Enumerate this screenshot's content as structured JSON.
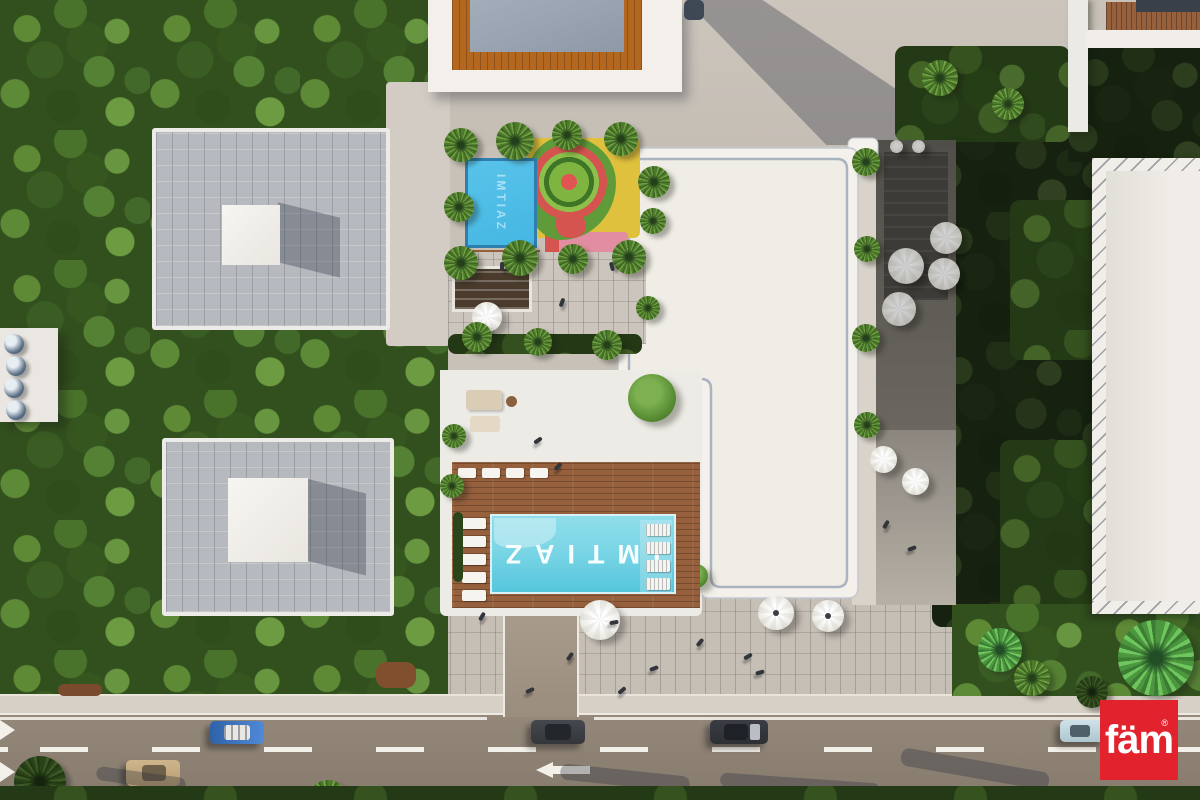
{
  "scene": {
    "description": "Aerial top-down 3D architectural render of the IMTIAZ residential development: central white L-shaped building with rooftop amenity deck, branded swimming pool, kids splash playground, landscaped villas among trees on the left, shaded cafe terrace with umbrellas on the right, and a three-lane road with cars along the bottom."
  },
  "branding": {
    "pool_text": "IMTIAZ",
    "pool_text_orientation": "rotated 180 degrees (reads ZAITMI)",
    "kids_pool_text": "IMTIAZ",
    "logo_text": "fäm",
    "registered_mark": "®"
  },
  "palette": {
    "logo_bg": "#e2232d",
    "logo_fg": "#ffffff",
    "pool_water": "#7ed7e6",
    "kids_pool_water": "#45b7e3",
    "deck_wood": "#96603d",
    "roof_white": "#f3f0eb",
    "pavement": "#c8c1b8",
    "plaza": "#c6bfb6",
    "road": "#8e8275",
    "road_marking": "#f3f0e9",
    "trees_green": "#32501e",
    "dome_blue": "#5b7086",
    "playground_green": "#5f9c39",
    "playground_red": "#d6544f",
    "playground_yellow": "#e0c13e",
    "playground_pink": "#e28da1",
    "frame_orange": "#b4671e",
    "villa_roof": "#b6b9be"
  },
  "road": {
    "direction_arrow": "left",
    "lanes": 3,
    "marking_style": "white dashed lane lines, solid edge line, merge chevrons at left edge",
    "cars": [
      {
        "color_name": "blue convertible with white interior",
        "hex": "#3f80cf",
        "lane": "upper"
      },
      {
        "color_name": "dark gray sedan",
        "hex": "#3b3e44",
        "lane": "upper"
      },
      {
        "color_name": "black sedan",
        "hex": "#303338",
        "lane": "upper"
      },
      {
        "color_name": "light blue car",
        "hex": "#bcd3db",
        "lane": "upper"
      },
      {
        "color_name": "beige sedan",
        "hex": "#c3a87e",
        "lane": "middle"
      }
    ]
  }
}
